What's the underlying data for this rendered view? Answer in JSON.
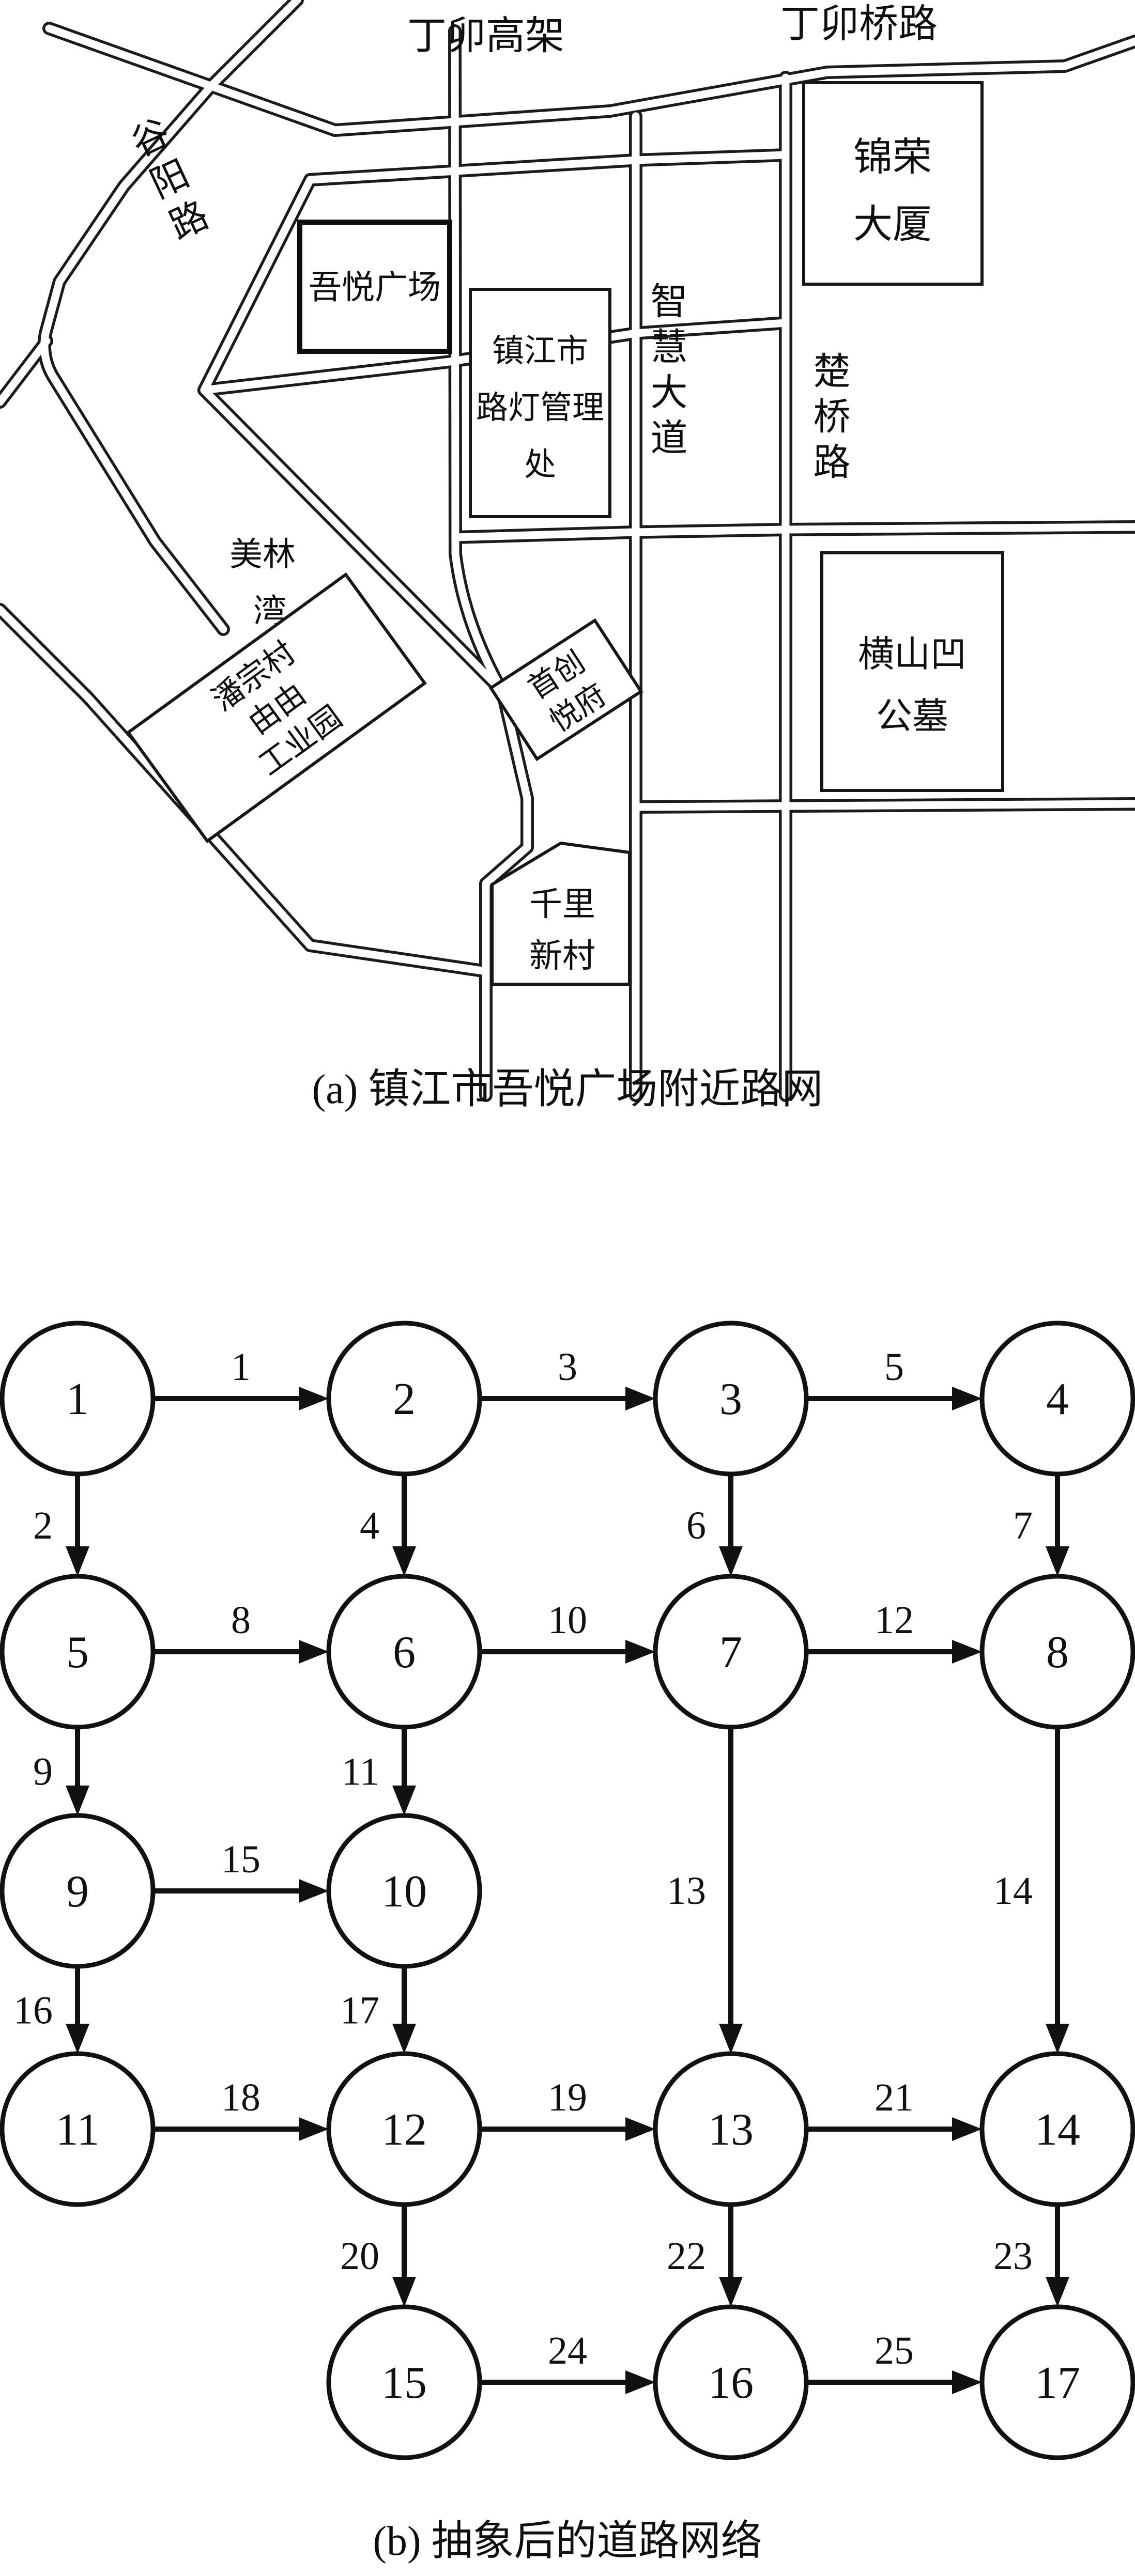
{
  "figure": {
    "caption_a": "(a) 镇江市吾悦广场附近路网",
    "caption_b": "(b) 抽象后的道路网络"
  },
  "map": {
    "road_labels": [
      {
        "id": "dingmao-viaduct",
        "text": "丁卯高架",
        "orientation": "horizontal"
      },
      {
        "id": "dingmaoqiao-road",
        "text": "丁卯桥路",
        "orientation": "horizontal"
      },
      {
        "id": "guyang-road",
        "text": "谷阳路",
        "orientation": "diagonal"
      },
      {
        "id": "zhihui-avenue",
        "text": "智慧大道",
        "orientation": "vertical"
      },
      {
        "id": "chuqiao-road",
        "text": "楚桥路",
        "orientation": "vertical"
      }
    ],
    "places": [
      {
        "id": "wuyue-plaza",
        "lines": [
          "吾悦广场"
        ],
        "boxed": true
      },
      {
        "id": "jinrong-tower",
        "lines": [
          "锦荣",
          "大厦"
        ],
        "boxed": true
      },
      {
        "id": "streetlight-office",
        "lines": [
          "镇江市",
          "路灯管理",
          "处"
        ],
        "boxed": true
      },
      {
        "id": "meilin-bay",
        "lines": [
          "美林",
          "湾"
        ],
        "boxed": false
      },
      {
        "id": "panzong-park",
        "lines": [
          "潘宗村",
          "由由",
          "工业园"
        ],
        "boxed": true
      },
      {
        "id": "shouchuang-mansion",
        "lines": [
          "首创",
          "悦府"
        ],
        "boxed": true
      },
      {
        "id": "hengshan-cemetery",
        "lines": [
          "横山凹",
          "公墓"
        ],
        "boxed": true
      },
      {
        "id": "qianli-village",
        "lines": [
          "千里",
          "新村"
        ],
        "boxed": true
      }
    ]
  },
  "graph": {
    "nodes": [
      {
        "id": "1",
        "col": 0,
        "row": 0
      },
      {
        "id": "2",
        "col": 1,
        "row": 0
      },
      {
        "id": "3",
        "col": 2,
        "row": 0
      },
      {
        "id": "4",
        "col": 3,
        "row": 0
      },
      {
        "id": "5",
        "col": 0,
        "row": 1
      },
      {
        "id": "6",
        "col": 1,
        "row": 1
      },
      {
        "id": "7",
        "col": 2,
        "row": 1
      },
      {
        "id": "8",
        "col": 3,
        "row": 1
      },
      {
        "id": "9",
        "col": 0,
        "row": 2
      },
      {
        "id": "10",
        "col": 1,
        "row": 2
      },
      {
        "id": "11",
        "col": 0,
        "row": 3
      },
      {
        "id": "12",
        "col": 1,
        "row": 3
      },
      {
        "id": "13",
        "col": 2,
        "row": 3
      },
      {
        "id": "14",
        "col": 3,
        "row": 3
      },
      {
        "id": "15",
        "col": 1,
        "row": 4
      },
      {
        "id": "16",
        "col": 2,
        "row": 4
      },
      {
        "id": "17",
        "col": 3,
        "row": 4
      }
    ],
    "edges": [
      {
        "label": "1",
        "from": "1",
        "to": "2"
      },
      {
        "label": "2",
        "from": "1",
        "to": "5"
      },
      {
        "label": "3",
        "from": "2",
        "to": "3"
      },
      {
        "label": "4",
        "from": "2",
        "to": "6"
      },
      {
        "label": "5",
        "from": "3",
        "to": "4"
      },
      {
        "label": "6",
        "from": "3",
        "to": "7"
      },
      {
        "label": "7",
        "from": "4",
        "to": "8"
      },
      {
        "label": "8",
        "from": "5",
        "to": "6"
      },
      {
        "label": "9",
        "from": "5",
        "to": "9"
      },
      {
        "label": "10",
        "from": "6",
        "to": "7"
      },
      {
        "label": "11",
        "from": "6",
        "to": "10"
      },
      {
        "label": "12",
        "from": "7",
        "to": "8"
      },
      {
        "label": "13",
        "from": "7",
        "to": "13"
      },
      {
        "label": "14",
        "from": "8",
        "to": "14"
      },
      {
        "label": "15",
        "from": "9",
        "to": "10"
      },
      {
        "label": "16",
        "from": "9",
        "to": "11"
      },
      {
        "label": "17",
        "from": "10",
        "to": "12"
      },
      {
        "label": "18",
        "from": "11",
        "to": "12"
      },
      {
        "label": "19",
        "from": "12",
        "to": "13"
      },
      {
        "label": "20",
        "from": "12",
        "to": "15"
      },
      {
        "label": "21",
        "from": "13",
        "to": "14"
      },
      {
        "label": "22",
        "from": "13",
        "to": "16"
      },
      {
        "label": "23",
        "from": "14",
        "to": "17"
      },
      {
        "label": "24",
        "from": "15",
        "to": "16"
      },
      {
        "label": "25",
        "from": "16",
        "to": "17"
      }
    ]
  }
}
